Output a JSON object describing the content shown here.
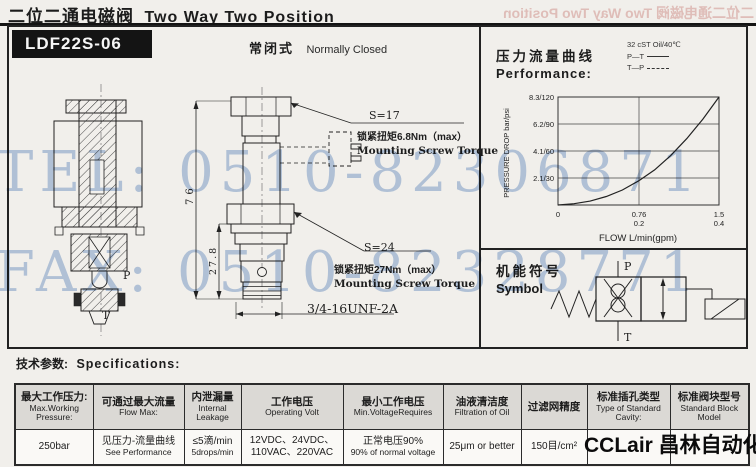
{
  "header": {
    "title_zh": "二位二通电磁阀",
    "title_en": "Two Way Two Position",
    "model": "LDF22S-06",
    "mode_zh": "常闭式",
    "mode_en": "Normally Closed"
  },
  "watermarks": {
    "tel": "TEL: 0510-82306871",
    "fax": "FAX: 0510-82328771",
    "ghost_title": "二位二通电磁阀 Two Way Two Position"
  },
  "drawing": {
    "s17": "S=17",
    "torque_top_zh": "锁紧扭矩6.8Nm（max）",
    "torque_top_en": "Mounting Screw Torque",
    "s24": "S=24",
    "torque_bottom_zh": "锁紧扭矩27Nm（max）",
    "torque_bottom_en": "Mounting Screw Torque",
    "thread": "3/4-16UNF-2A",
    "dim_total": "76",
    "dim_lower": "27.8",
    "port_p": "P",
    "port_t": "T"
  },
  "performance": {
    "title_zh": "压力流量曲线",
    "title_en": "Performance:",
    "legend_oil": "32 cST Oil/40℃",
    "legend_pt": "P—T",
    "legend_tp": "T—P"
  },
  "chart_data": {
    "type": "line",
    "title": "压力流量曲线 Performance",
    "xlabel": "FLOW L/min(gpm)",
    "ylabel": "PRESSURE DROP bar/psi",
    "xlim": [
      0,
      1.5
    ],
    "ylim_bar": [
      0,
      8.3
    ],
    "grid": true,
    "legend_position": "top-right",
    "legend": [
      "32 cST Oil/40℃",
      "P—T (solid)",
      "T—P (dashed)"
    ],
    "y_ticks": [
      "2.1/30",
      "4.1/60",
      "6.2/90",
      "8.3/120"
    ],
    "x_ticks_lmin": [
      "0",
      "0.76",
      "1.5"
    ],
    "x_ticks_gpm": [
      "",
      "0.2",
      "0.4"
    ],
    "series": [
      {
        "name": "P—T",
        "x": [
          0,
          0.15,
          0.3,
          0.45,
          0.6,
          0.76,
          0.9,
          1.05,
          1.2,
          1.35,
          1.5
        ],
        "y_bar": [
          0,
          0.1,
          0.3,
          0.65,
          1.15,
          1.9,
          2.7,
          3.8,
          5.1,
          6.6,
          8.3
        ]
      }
    ]
  },
  "symbol": {
    "title_zh": "机能符号",
    "title_en": "Symbol",
    "port_p": "P",
    "port_t": "T"
  },
  "specs": {
    "heading_zh": "技术参数:",
    "heading_en": "Specifications:",
    "columns": [
      {
        "zh": "最大工作压力:",
        "en": "Max.Working Pressure:",
        "v1": "250bar",
        "v2": ""
      },
      {
        "zh": "可通过最大流量",
        "en": "Flow Max:",
        "v1": "见压力-流量曲线",
        "v2": "See Performance"
      },
      {
        "zh": "内泄漏量",
        "en": "Internal Leakage",
        "v1": "≤5滴/min",
        "v2": "5drops/min"
      },
      {
        "zh": "工作电压",
        "en": "Operating Volt",
        "v1": "12VDC、24VDC、",
        "v2": "110VAC、220VAC"
      },
      {
        "zh": "最小工作电压",
        "en": "Min.VoltageRequires",
        "v1": "正常电压90%",
        "v2": "90% of normal voltage"
      },
      {
        "zh": "油液清洁度",
        "en": "Filtration of Oil",
        "v1": "25μm or better",
        "v2": ""
      },
      {
        "zh": "过滤网精度",
        "en": "",
        "v1": "150目/cm²",
        "v2": ""
      },
      {
        "zh": "标准插孔类型",
        "en": "Type of Standard Cavity:",
        "v1": "",
        "v2": ""
      },
      {
        "zh": "标准阀块型号",
        "en": "Standard Block Model",
        "v1": "",
        "v2": ""
      }
    ]
  },
  "logo": {
    "text": "CCLair 昌林自动化",
    "suffix": "3*"
  }
}
